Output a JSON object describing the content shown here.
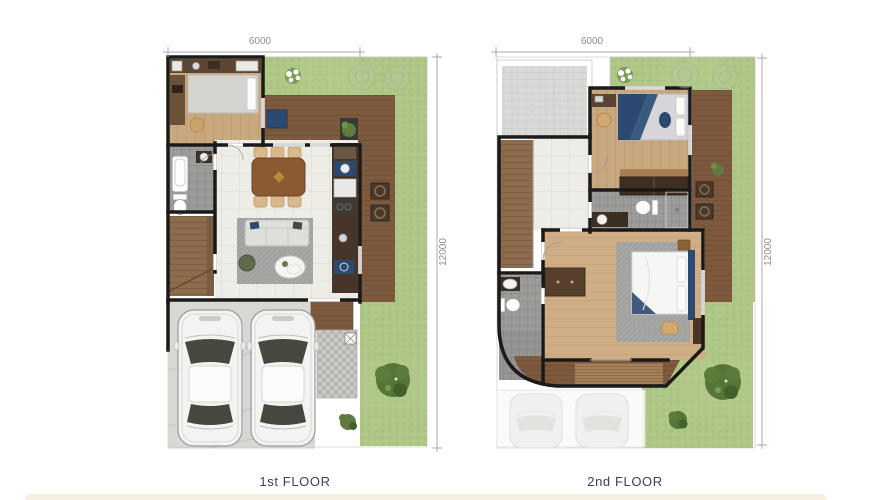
{
  "plans": [
    {
      "label": "1st FLOOR",
      "width_dim": "6000",
      "height_dim": "12000"
    },
    {
      "label": "2nd FLOOR",
      "width_dim": "6000",
      "height_dim": "12000"
    }
  ],
  "colors": {
    "lawn": "#aec786",
    "lawn_dark": "#9fb673",
    "deck": "#7d5a3e",
    "wall": "#1a1a1a",
    "wood_floor": "#c9a87f",
    "tile": "#edece6",
    "bath_tile": "#9c9c9a",
    "concrete": "#d7d7d4",
    "roof": "#d9d9d7",
    "navy": "#2c4a71",
    "stair": "#8d6c4e",
    "rug": "#a6a6a4",
    "label_text": "#3b4254",
    "dim_text": "#8c8c8c",
    "dim_line": "#a9a9a7",
    "bottom_bar": "#f6efdf"
  }
}
